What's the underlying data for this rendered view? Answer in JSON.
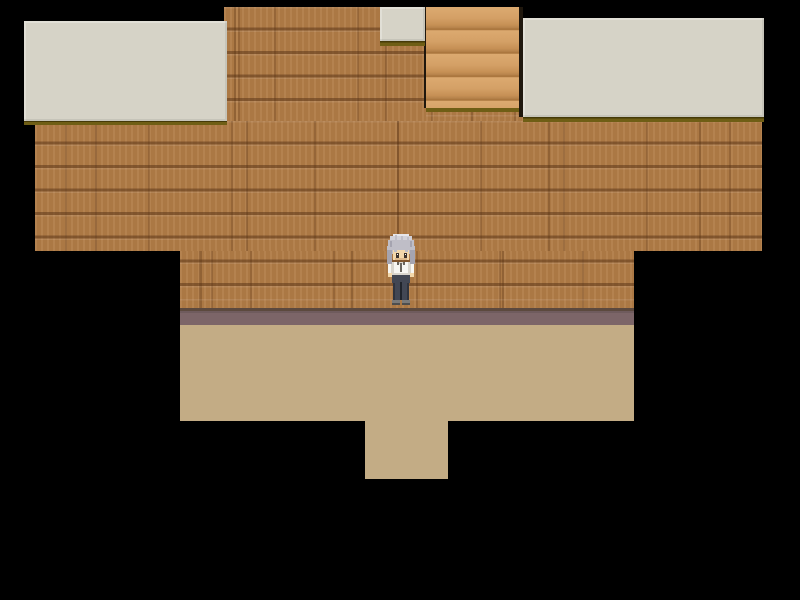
{
  "scene": {
    "view": "top-down RPG room interior",
    "room": {
      "wall_material": "brown wooden plank wall",
      "floor_material": "plain tan floor",
      "ceiling_panels": "light gray roof panels with dark olive edge",
      "stairs": "light wood stair strip in upper wall",
      "exit": "floor opening at bottom center"
    },
    "player": {
      "facing": "down",
      "hair": "silver gray",
      "top": "white shirt",
      "bottom": "dark gray pants",
      "position": "center of room, standing against wall above floor"
    }
  },
  "palette": {
    "bg": "#000000",
    "brick_base": "#b17c47",
    "brick_line": "#8a5a33",
    "ceiling_panel": "#d6d3c7",
    "ceiling_border": "#6f5e15",
    "ceiling_border_dark": "#453a08",
    "stairs_light": "#d9a468",
    "stairs_dark": "#ab773f",
    "gap_shadow": "#1f170d",
    "wall_base_line": "#5c493e",
    "skirting": "#7c6568",
    "floor": "#c3ac85"
  },
  "sprite_palette": {
    "sp_hair_hi": "#e7e6ea",
    "sp_hair_light": "#d2d1d8",
    "sp_hair_mid": "#bfbec7",
    "sp_hair_dark": "#a5a4b0",
    "sp_skin": "#f3d8ab",
    "sp_skin_shadow": "#ddb98b",
    "sp_eye": "#3c322c",
    "sp_shirt": "#f7f6f2",
    "sp_shirt_shade": "#d9d5cd",
    "sp_collar": "#6a655e",
    "sp_pants": "#424754",
    "sp_pants_dark": "#30343e",
    "sp_seam": "#20242c",
    "sp_shoe": "#7a7a7a",
    "sp_shoe_dark": "#4e4e4e"
  }
}
